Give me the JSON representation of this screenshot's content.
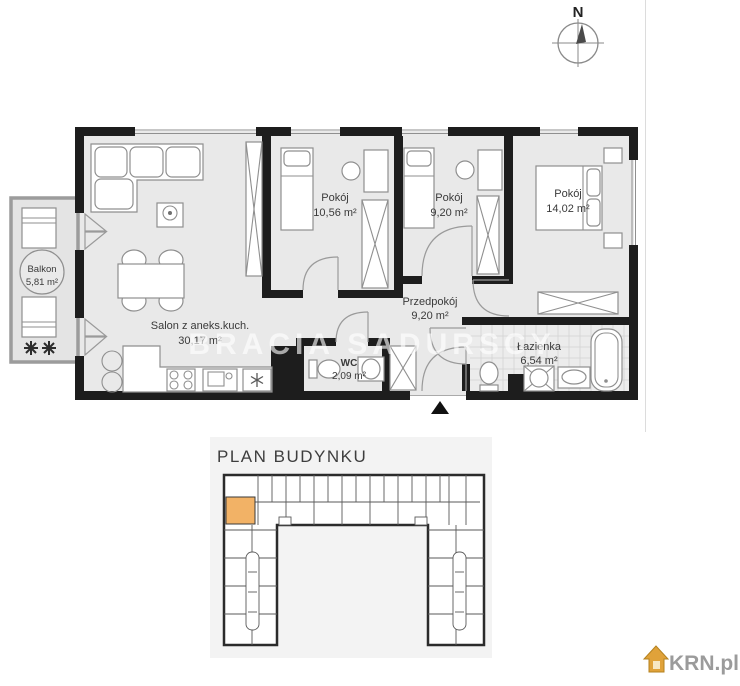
{
  "compass": {
    "label": "N"
  },
  "apartment": {
    "watermark": "BRACIA SADURSCY",
    "rooms": {
      "balkon": {
        "name": "Balkon",
        "area": "5,81 m²"
      },
      "salon": {
        "name": "Salon z aneks.kuch.",
        "area": "30,17 m²"
      },
      "pokoj1": {
        "name": "Pokój",
        "area": "10,56 m²"
      },
      "pokoj2": {
        "name": "Pokój",
        "area": "9,20 m²"
      },
      "pokoj3": {
        "name": "Pokój",
        "area": "14,02 m²"
      },
      "przedpokoj": {
        "name": "Przedpokój",
        "area": "9,20 m²"
      },
      "wc": {
        "name": "WC",
        "area": "2,09 m²"
      },
      "lazienka": {
        "name": "Łazienka",
        "area": "6,54 m²"
      }
    }
  },
  "building_plan": {
    "title": "PLAN BUDYNKU",
    "highlight_color": "#f2b266"
  },
  "branding": {
    "logo_text": "KRN.pl",
    "logo_house_color": "#e0a23a",
    "logo_text_color": "#9b9b9b"
  },
  "colors": {
    "wall": "#1d1d1d",
    "floor": "#e9e9e9",
    "panel_background": "#f3f3f3"
  }
}
